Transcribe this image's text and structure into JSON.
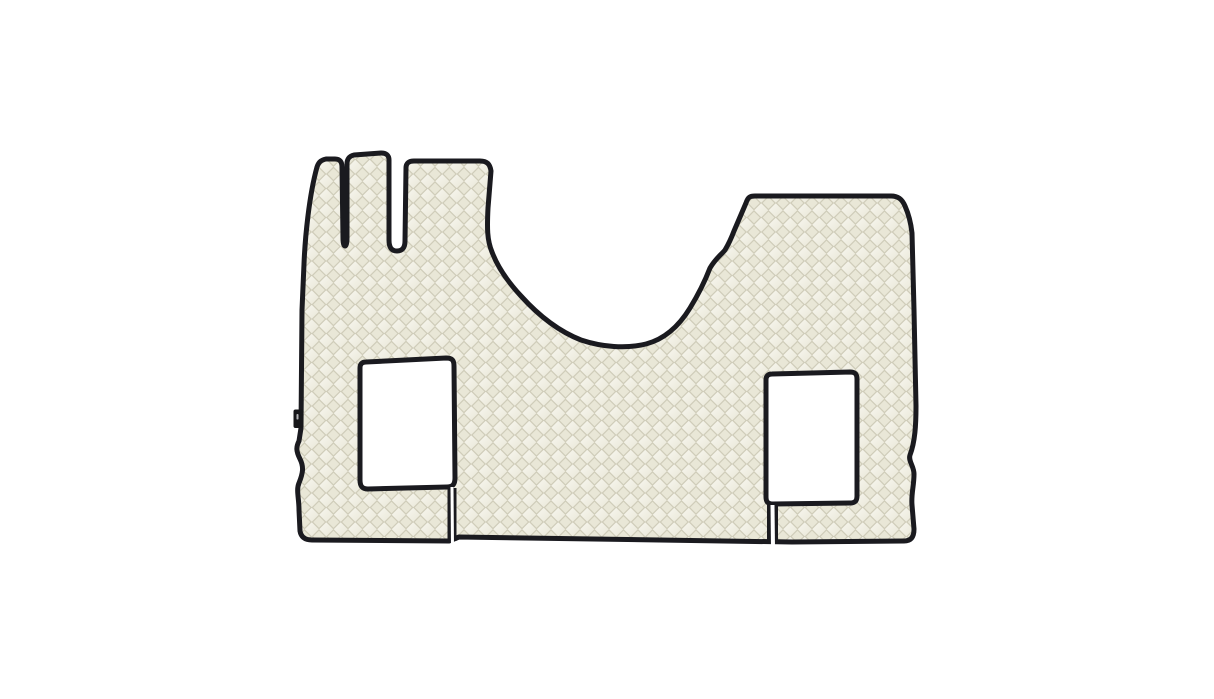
{
  "image": {
    "type": "product-photo",
    "subject": "Quilted eco-leather truck cabin floor mat set",
    "description": "Cream diamond-quilted truck floor mat set with dark edge piping on a plain white background: three narrow pedal-area fingers at top left, a deep engine-tunnel recess at top centre, a raised rectangular section at top right, two rectangular seat-base cutouts with piped edges, short seam gaps running from each cutout to the bottom edge, and a small dark brand tag on the left edge",
    "visible_text": ""
  },
  "colors": {
    "background": "#ffffff",
    "mat_base": "#f1efe3",
    "mat_highlight": "#f8f7f0",
    "mat_shadow": "#e9e7d7",
    "stitch": "#cfccb9",
    "piping": "#1a1a1f",
    "tag": "#17171a",
    "seam_gap": "#ffffff"
  },
  "elements": {
    "mat_label": "floor-mat",
    "left_cutout_label": "left seat-base cutout",
    "right_cutout_label": "right seat-base cutout",
    "tunnel_label": "engine tunnel recess",
    "tag_label": "brand tag",
    "left_seam_label": "seam below left cutout",
    "right_seam_label": "seam below right cutout"
  }
}
